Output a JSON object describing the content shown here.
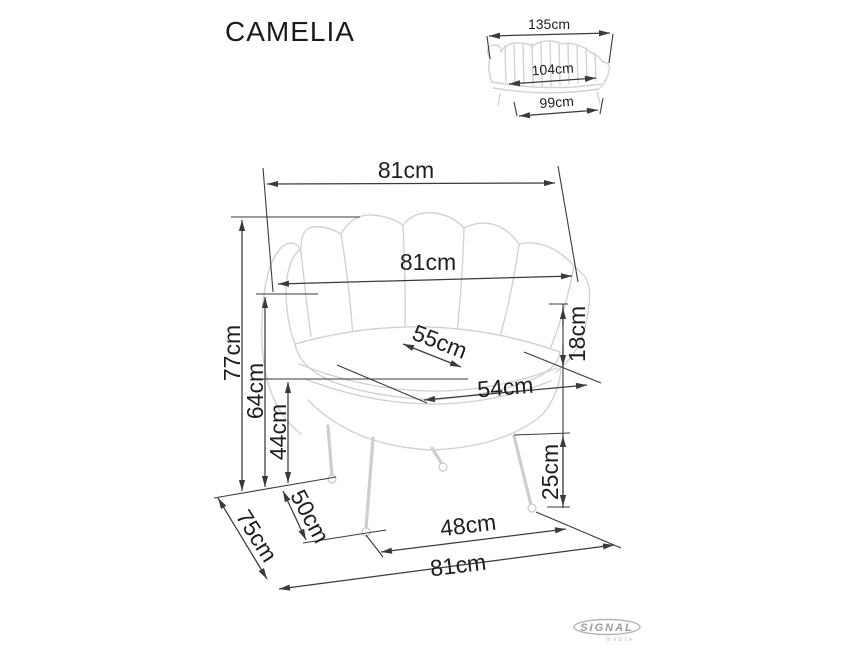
{
  "title": "CAMELIA",
  "brand": {
    "name": "SIGNAL",
    "subtitle": "meble"
  },
  "colors": {
    "dimension_line": "#3a3a3a",
    "furniture_outline": "#d2d2d2",
    "logo_gray": "#9c9c9c",
    "background": "#ffffff"
  },
  "thumbnail": {
    "view": "sofa-front-view-small",
    "dimensions": {
      "overall_width": "135cm",
      "seat_width": "104cm",
      "base_width": "99cm"
    }
  },
  "main_drawing": {
    "view": "armchair-front-view",
    "dimensions": {
      "overall_width_top": "81cm",
      "backrest_width": "81cm",
      "overall_height": "77cm",
      "back_height": "64cm",
      "seat_height": "44cm",
      "seat_depth_diagonal": "55cm",
      "cushion_height": "18cm",
      "seat_width": "54cm",
      "leg_height": "25cm",
      "leg_spacing_depth": "50cm",
      "overall_depth": "75cm",
      "front_leg_spacing": "48cm",
      "overall_width_base": "81cm"
    }
  }
}
